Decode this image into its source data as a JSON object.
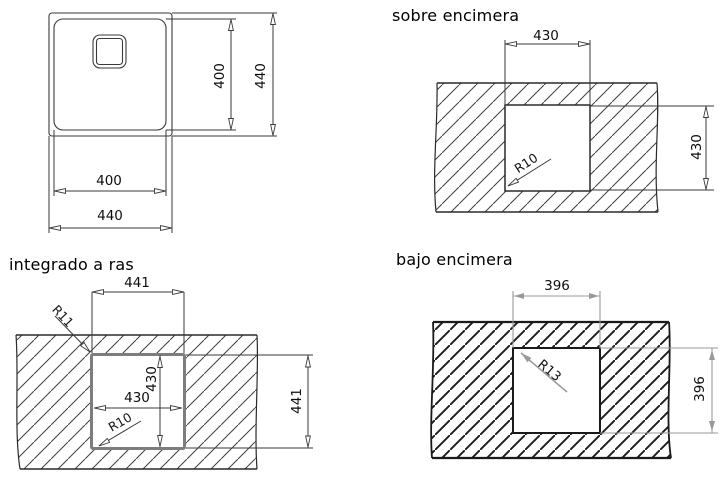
{
  "figure": {
    "description": "Sink installation cutout diagrams",
    "background": "#ffffff"
  },
  "colors": {
    "line": "#3a3a3a",
    "bold_line": "#1f1f1f",
    "gray_dim": "#999999",
    "flush_border": "#7d7d7d",
    "text": "#0d0d0d"
  },
  "sink_plan": {
    "inner_width": "400",
    "outer_width": "440",
    "inner_height": "400",
    "outer_height": "440"
  },
  "sobre_encimera": {
    "title": "sobre encimera",
    "cutout_width": "430",
    "cutout_height": "430",
    "corner_radius": "R10"
  },
  "integrado_a_ras": {
    "title": "integrado a ras",
    "outer_width": "441",
    "outer_height": "441",
    "inner_width": "430",
    "inner_height": "430",
    "top_corner_radius": "R11",
    "bottom_corner_radius": "R10"
  },
  "bajo_encimera": {
    "title": "bajo encimera",
    "cutout_width": "396",
    "cutout_height": "396",
    "corner_radius": "R13"
  }
}
